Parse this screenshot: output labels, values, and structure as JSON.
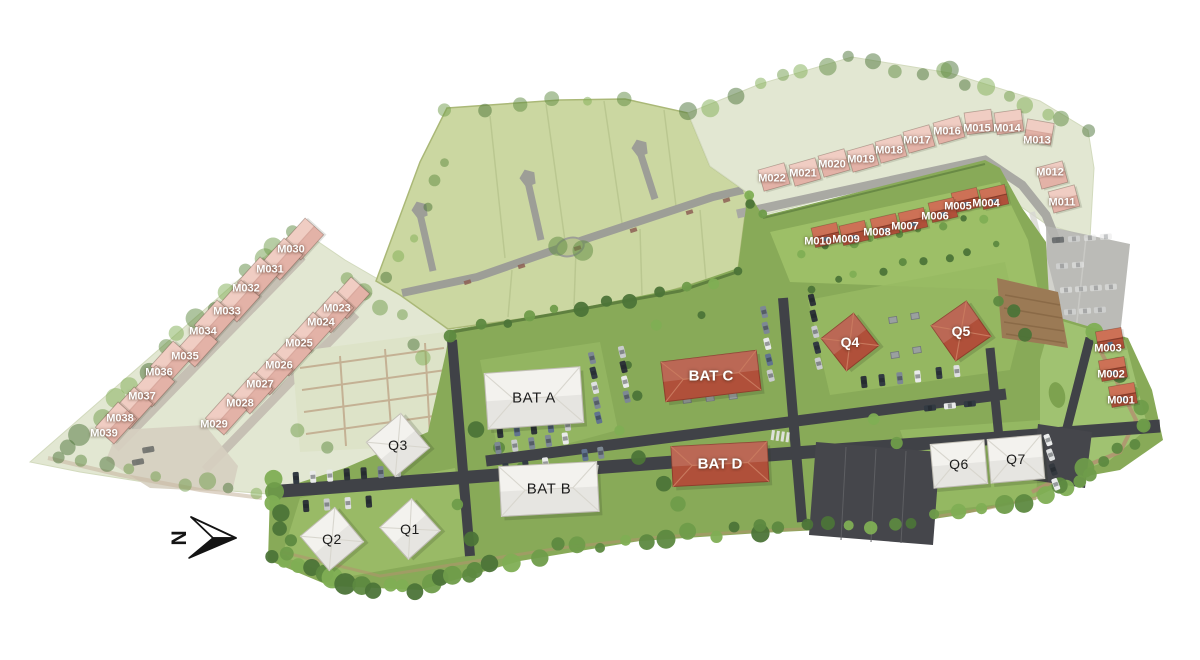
{
  "north_arrow": {
    "letter": "N"
  },
  "colors": {
    "background": "#ffffff",
    "grass_bright": "#88aa58",
    "grass_washed": "#e2e7d2",
    "field_green": "#cbd7a1",
    "road_dark": "#404247",
    "road_washed": "#a9a9a3",
    "roof_red": "#b0503a",
    "roof_red_light": "#cd7156",
    "roof_washed": "#e3b2a7",
    "roof_washed_light": "#f0cdc3",
    "building_white": "#f3f2ee",
    "label_light": "#ffffff",
    "label_dark": "#1c1c1c"
  },
  "buildings": [
    {
      "id": "BAT A",
      "x": 534,
      "y": 398,
      "w": 96,
      "h": 56,
      "angle": -4,
      "style": "white"
    },
    {
      "id": "BAT B",
      "x": 549,
      "y": 489,
      "w": 98,
      "h": 50,
      "angle": -3,
      "style": "white"
    },
    {
      "id": "BAT C",
      "x": 711,
      "y": 376,
      "w": 96,
      "h": 40,
      "angle": -7,
      "style": "red"
    },
    {
      "id": "BAT D",
      "x": 720,
      "y": 464,
      "w": 96,
      "h": 40,
      "angle": -3,
      "style": "red"
    },
    {
      "id": "Q1",
      "x": 410,
      "y": 529,
      "w": 43,
      "h": 43,
      "angle": -42,
      "style": "white"
    },
    {
      "id": "Q2",
      "x": 332,
      "y": 539,
      "w": 45,
      "h": 45,
      "angle": -40,
      "style": "white"
    },
    {
      "id": "Q3",
      "x": 398,
      "y": 445,
      "w": 45,
      "h": 45,
      "angle": -40,
      "style": "white"
    },
    {
      "id": "Q4",
      "x": 850,
      "y": 342,
      "w": 41,
      "h": 41,
      "angle": -38,
      "style": "red"
    },
    {
      "id": "Q5",
      "x": 961,
      "y": 331,
      "w": 43,
      "h": 43,
      "angle": -35,
      "style": "red"
    },
    {
      "id": "Q6",
      "x": 959,
      "y": 464,
      "w": 54,
      "h": 44,
      "angle": -5,
      "style": "white"
    },
    {
      "id": "Q7",
      "x": 1016,
      "y": 459,
      "w": 54,
      "h": 44,
      "angle": -5,
      "style": "white"
    }
  ],
  "houses": [
    {
      "id": "M001",
      "x": 1121,
      "y": 401,
      "group": "right"
    },
    {
      "id": "M002",
      "x": 1111,
      "y": 375,
      "group": "right"
    },
    {
      "id": "M003",
      "x": 1108,
      "y": 349,
      "group": "right",
      "dy": -9
    },
    {
      "id": "M004",
      "x": 986,
      "y": 204,
      "group": "bright"
    },
    {
      "id": "M005",
      "x": 958,
      "y": 207,
      "group": "bright"
    },
    {
      "id": "M006",
      "x": 935,
      "y": 217,
      "group": "bright"
    },
    {
      "id": "M007",
      "x": 905,
      "y": 227,
      "group": "bright"
    },
    {
      "id": "M008",
      "x": 877,
      "y": 233,
      "group": "bright"
    },
    {
      "id": "M009",
      "x": 846,
      "y": 240,
      "group": "bright"
    },
    {
      "id": "M010",
      "x": 818,
      "y": 242,
      "group": "bright"
    },
    {
      "id": "M011",
      "x": 1062,
      "y": 203,
      "group": "fadedTop",
      "ang": -15,
      "dx": 2,
      "dy": -4
    },
    {
      "id": "M012",
      "x": 1050,
      "y": 173,
      "group": "fadedTop",
      "ang": -15,
      "dx": 2,
      "dy": 2
    },
    {
      "id": "M013",
      "x": 1037,
      "y": 141,
      "group": "fadedTop",
      "ang": 10,
      "dy": -9
    },
    {
      "id": "M014",
      "x": 1007,
      "y": 129,
      "group": "fadedTop",
      "ang": -8,
      "dy": -7
    },
    {
      "id": "M015",
      "x": 977,
      "y": 129,
      "group": "fadedTop",
      "ang": -8,
      "dy": -7
    },
    {
      "id": "M016",
      "x": 947,
      "y": 132,
      "group": "fadedTop"
    },
    {
      "id": "M017",
      "x": 917,
      "y": 141,
      "group": "fadedTop"
    },
    {
      "id": "M018",
      "x": 889,
      "y": 151,
      "group": "fadedTop"
    },
    {
      "id": "M019",
      "x": 861,
      "y": 160,
      "group": "fadedTop"
    },
    {
      "id": "M020",
      "x": 832,
      "y": 165,
      "group": "fadedTop"
    },
    {
      "id": "M021",
      "x": 803,
      "y": 174,
      "group": "fadedTop"
    },
    {
      "id": "M022",
      "x": 772,
      "y": 179,
      "group": "fadedTop"
    },
    {
      "id": "M023",
      "x": 337,
      "y": 309,
      "group": "fadedLeft"
    },
    {
      "id": "M024",
      "x": 321,
      "y": 323,
      "group": "fadedLeft"
    },
    {
      "id": "M025",
      "x": 299,
      "y": 344,
      "group": "fadedLeft"
    },
    {
      "id": "M026",
      "x": 279,
      "y": 366,
      "group": "fadedLeft"
    },
    {
      "id": "M027",
      "x": 260,
      "y": 385,
      "group": "fadedLeft"
    },
    {
      "id": "M028",
      "x": 240,
      "y": 404,
      "group": "fadedLeft"
    },
    {
      "id": "M029",
      "x": 214,
      "y": 425,
      "group": "fadedLeft"
    },
    {
      "id": "M030",
      "x": 291,
      "y": 250,
      "group": "fadedLeft"
    },
    {
      "id": "M031",
      "x": 270,
      "y": 270,
      "group": "fadedLeft"
    },
    {
      "id": "M032",
      "x": 246,
      "y": 289,
      "group": "fadedLeft"
    },
    {
      "id": "M033",
      "x": 227,
      "y": 312,
      "group": "fadedLeft"
    },
    {
      "id": "M034",
      "x": 203,
      "y": 332,
      "group": "fadedLeft"
    },
    {
      "id": "M035",
      "x": 185,
      "y": 357,
      "group": "fadedLeft"
    },
    {
      "id": "M036",
      "x": 159,
      "y": 373,
      "group": "fadedLeft"
    },
    {
      "id": "M037",
      "x": 142,
      "y": 397,
      "group": "fadedLeft"
    },
    {
      "id": "M038",
      "x": 120,
      "y": 419,
      "group": "fadedLeft"
    },
    {
      "id": "M039",
      "x": 104,
      "y": 434,
      "group": "fadedLeft"
    }
  ]
}
